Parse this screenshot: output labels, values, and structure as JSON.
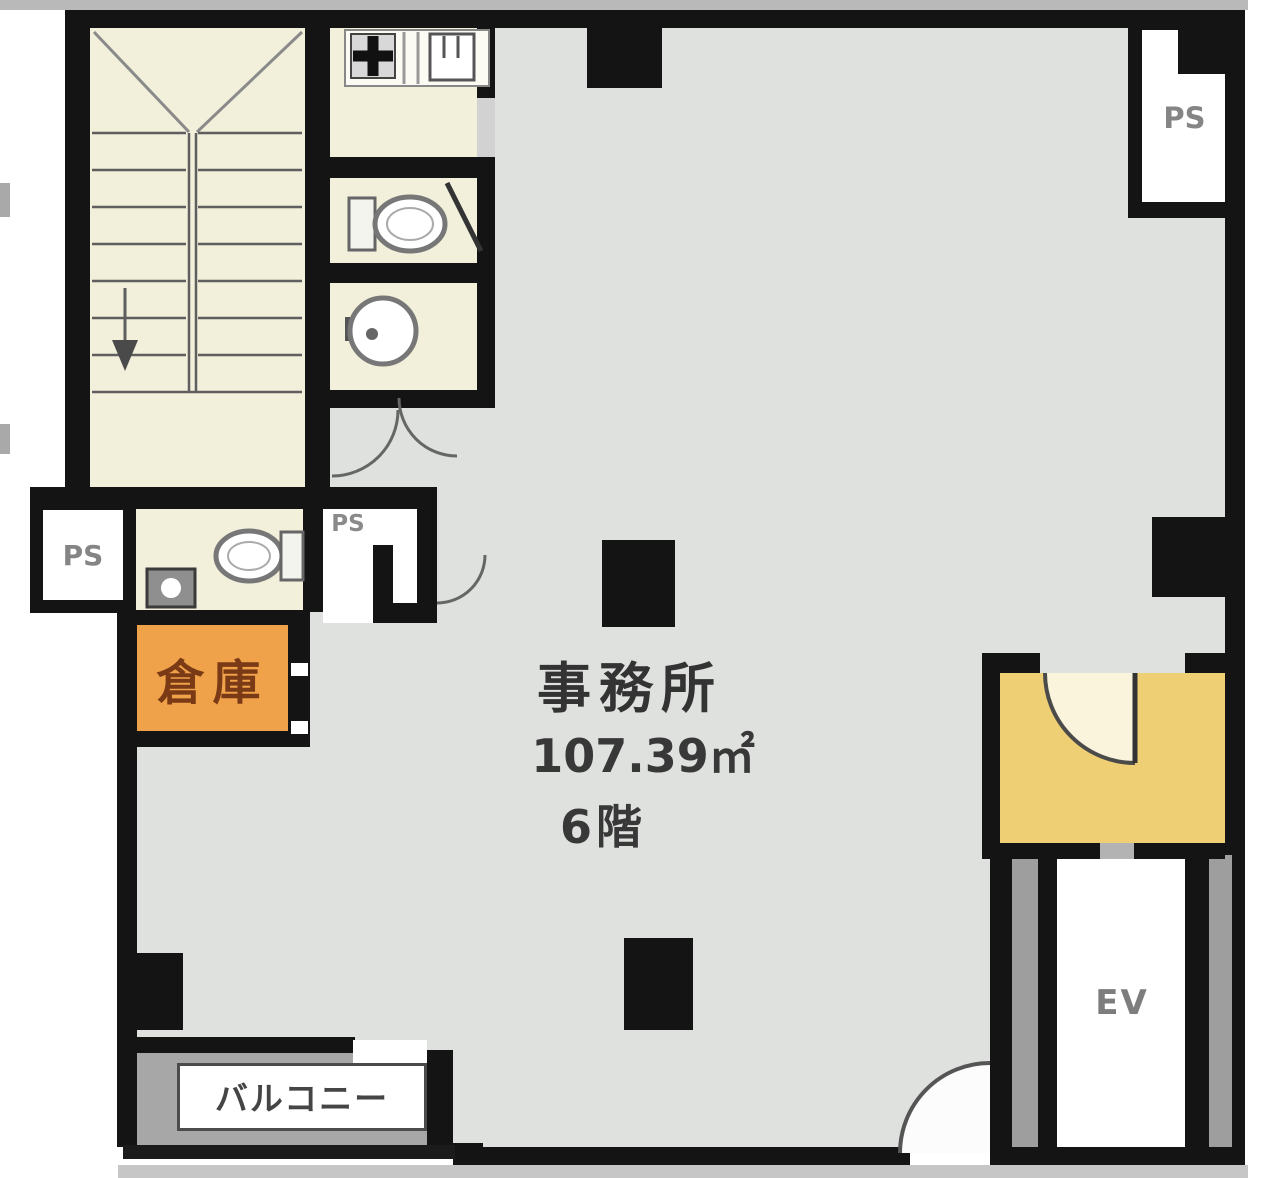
{
  "floor_plan": {
    "title_block": {
      "room_name": "事務所",
      "area": "107.39㎡",
      "floor": "6階"
    },
    "labels": {
      "storage": "倉庫",
      "balcony": "バルコニー",
      "elevator": "EV",
      "pipe_space_left": "PS",
      "pipe_space_hall": "PS",
      "pipe_space_upper_right": "PS"
    },
    "colors": {
      "wall": "#141414",
      "office_floor": "#dee1dd",
      "service_room_fill": "#f2efda",
      "storage_fill": "#f0a24a",
      "storage_text": "#7a3a15",
      "elevator_hall_fill": "#eecf73",
      "balcony_fill": "#a7a7a7",
      "label_text_gray": "#7d7d7d"
    }
  }
}
